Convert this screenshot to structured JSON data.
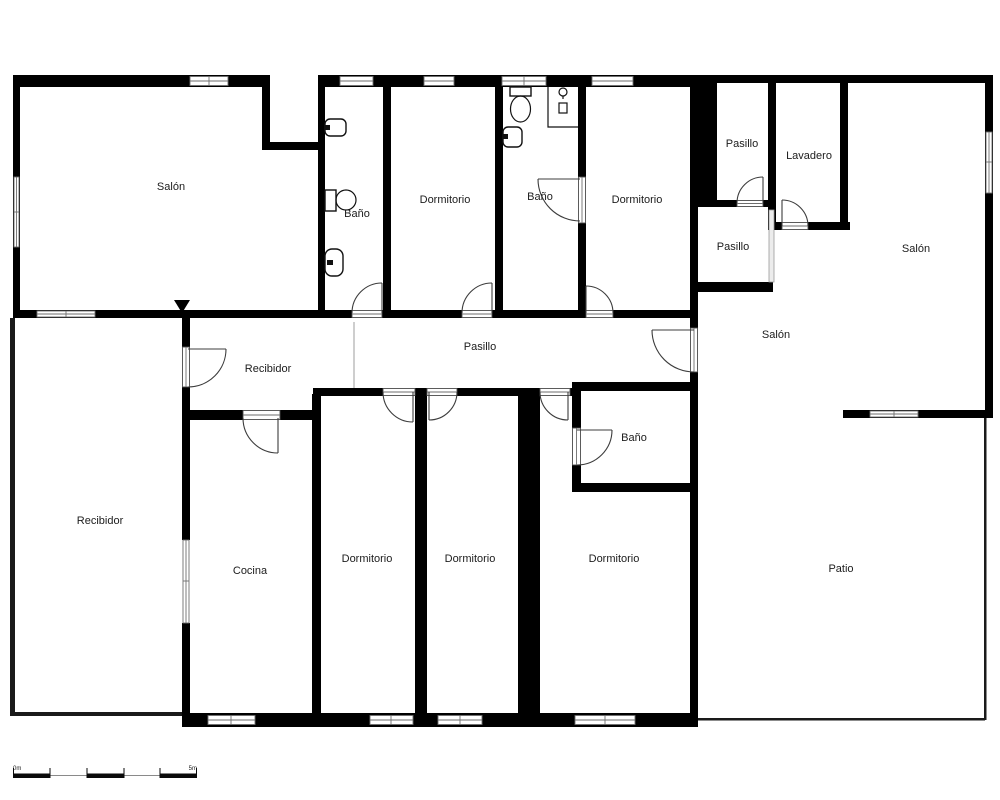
{
  "plan": {
    "rooms": {
      "salon_top_left": "Salón",
      "bano_1": "Baño",
      "dormitorio_1": "Dormitorio",
      "bano_2": "Baño",
      "dormitorio_2": "Dormitorio",
      "pasillo_small_top": "Pasillo",
      "lavadero": "Lavadero",
      "salon_right": "Salón",
      "pasillo_small_mid": "Pasillo",
      "salon_mid": "Salón",
      "pasillo_corridor": "Pasillo",
      "recibidor_vestibule": "Recibidor",
      "recibidor_main": "Recibidor",
      "cocina": "Cocina",
      "dormitorio_3": "Dormitorio",
      "dormitorio_4": "Dormitorio",
      "dormitorio_5": "Dormitorio",
      "bano_3": "Baño",
      "patio": "Patio"
    },
    "scale_bar": {
      "start": "0m",
      "end": "5m"
    },
    "colors": {
      "wall": "#000000",
      "background": "#ffffff",
      "door": "#3c3c3c",
      "window_frame": "#6e6e6e"
    }
  }
}
